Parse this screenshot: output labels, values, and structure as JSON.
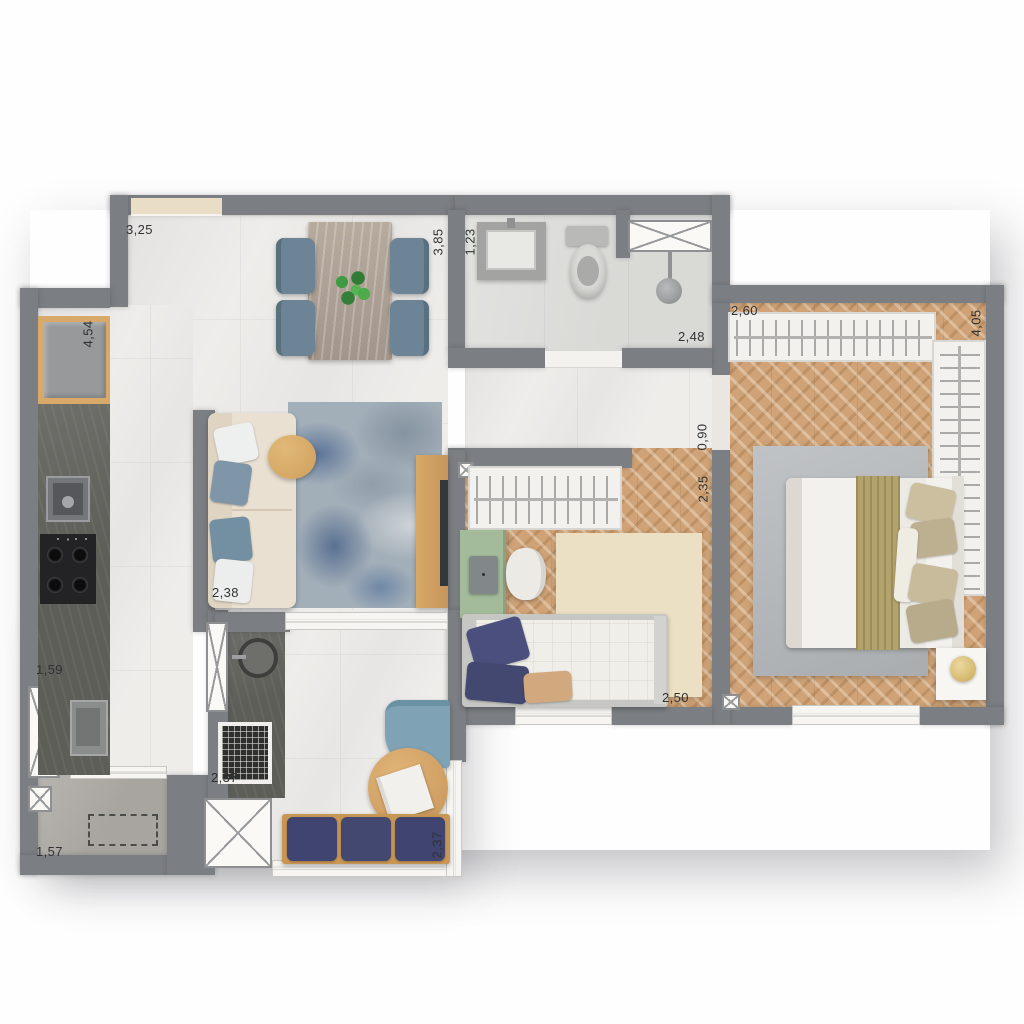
{
  "title": "apartment-floor-plan",
  "dims": {
    "d325": "3,25",
    "d385": "3,85",
    "d123": "1,23",
    "d248": "2,48",
    "d260": "2,60",
    "d405": "4,05",
    "d454": "4,54",
    "d090": "0,90",
    "d235": "2,35",
    "d238": "2,38",
    "d159": "1,59",
    "d250": "2,50",
    "d157": "1,57",
    "d237_grill": "2,37",
    "d237_balcony": "2,37"
  },
  "colors": {
    "wall": "#7b7e82",
    "marble_floor": "#efedea",
    "wood_floor": "#cfa377",
    "bath_floor": "#d9d9d6",
    "service_floor": "#a8a5a0",
    "counter_dark": "#5e5e59",
    "sofa_cream": "#e9e0d2",
    "pillow_blue": "#7e96a8",
    "navy_cushion": "#434870",
    "rug_blue_grey": "#8fa0b0",
    "rug_cream": "#ebe0c4",
    "rug_grey": "#b5b8ba",
    "desk_green": "#a3bb9b",
    "wood_furniture": "#d1a160",
    "olive_throw": "#b2a26c",
    "lamp_gold": "#d8bc72",
    "plant_green": "#3f9b43"
  },
  "semantics": {
    "areas": [
      "dining-living",
      "kitchen",
      "bathroom",
      "hallway",
      "bedroom-1",
      "bedroom-2",
      "service-area",
      "balcony-gourmet"
    ],
    "fixtures": [
      "fridge",
      "cooktop",
      "kitchen-sink",
      "laundry-tub",
      "vanity-sink",
      "toilet",
      "shower-head",
      "barbecue-grill",
      "round-sink",
      "wardrobes",
      "shaft-boxes",
      "windows",
      "sliding-doors"
    ]
  }
}
